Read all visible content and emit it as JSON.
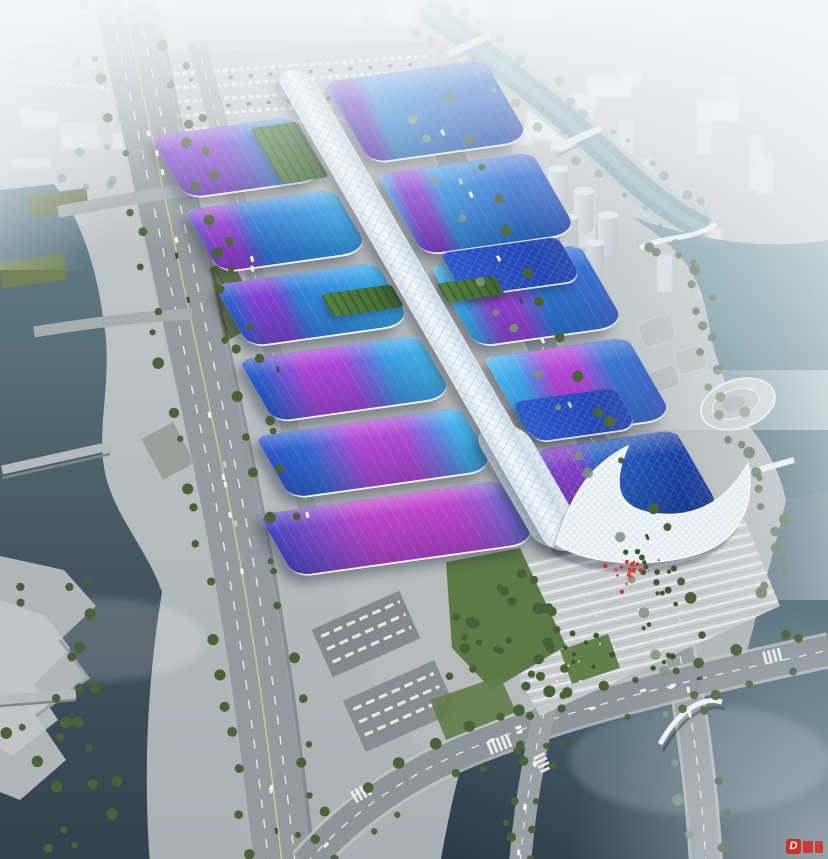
{
  "meta": {
    "type": "architectural-aerial-rendering",
    "description": "Bird's-eye rendering of a huge exhibition and convention center: two rows of wave-shaped exhibition-hall roofs in gradient blue with sweeping magenta-purple ribbon stripes flank a long white quilted central concourse spine that ends in a sculptural white wave-shaped entrance canopy and a striped palm-lined entry plaza with red festive decorations. The site is surrounded by service aprons, a tree-lined elevated riverside expressway on the left, canals and rivers with bridges, parking lots with cars and buses, lawns, terraced waterfront parks, and a hazy white city skyline fading into fog at the top."
  },
  "colors": {
    "land": "#b6babc",
    "waterRiver": "#5d7a85",
    "waterDark": "#2e3f4b",
    "waterCanal": "#7ca3ab",
    "waterRight": "#6d95a0",
    "road": "#8e959a",
    "roadMinor": "#a8adb0",
    "roadEdge": "#c3c8ca",
    "tree": "#4b6138",
    "treeHazy": "#7f947e",
    "treeBank": "#5e7452",
    "lawn": "#5c7a46",
    "palm": "#3a5a2c",
    "roofCyan": "#42b2ec",
    "roofBlue": "#2356c8",
    "roofDeep": "#12359a",
    "ribbonMagenta": "#b24ad6",
    "ribbonPurple": "#7e46d2",
    "spineWhite": "#eef4f8",
    "shellWhite": "#f4f7f9",
    "plazaBase": "#c7cbcd",
    "plazaStripe": "#e8eaeb",
    "redDecor": "#cc3526",
    "wmRed": "#d5281e",
    "cityBlock": "#e0e6ea"
  },
  "watermark": {
    "letter": "D"
  },
  "complex": {
    "halls_left": [
      {
        "w": 132,
        "g": [
          "#6a46c8",
          "#35a0e4"
        ],
        "ribbon": 26,
        "rw": 40,
        "rc": "#8a4ad2"
      },
      {
        "w": 140,
        "g": [
          "#2d62cc",
          "#38a8e8"
        ],
        "ribbon": 16,
        "rw": 22,
        "rc": "#9244ce"
      },
      {
        "w": 152,
        "g": [
          "#2b60cc",
          "#3cb0ea"
        ],
        "ribbon": 24,
        "rw": 20,
        "rc": "#7e46d2"
      },
      {
        "w": 168,
        "g": [
          "#2758c8",
          "#46b8ec"
        ],
        "ribbon": 40,
        "rw": 34,
        "rc": "#a848d8"
      },
      {
        "w": 192,
        "g": [
          "#2b55c6",
          "#48baee"
        ],
        "ribbon": 54,
        "rw": 34,
        "rc": "#b24ad6"
      },
      {
        "w": 228,
        "g": [
          "#3c43bc",
          "#3f98e2"
        ],
        "ribbon": 56,
        "rw": 58,
        "rc": "#bc46cc"
      }
    ],
    "halls_right": [
      {
        "w": 150,
        "g": [
          "#38a2e6",
          "#1e4cc0"
        ],
        "ribbon": 10,
        "rw": 14,
        "rc": "#6a3ec4"
      },
      {
        "w": 145,
        "g": [
          "#3cacea",
          "#2152c4"
        ],
        "ribbon": 16,
        "rw": 16,
        "rc": "#8844d0"
      },
      {
        "w": 140,
        "g": [
          "#42b2ec",
          "#2257c8"
        ],
        "ribbon": 34,
        "rw": 24,
        "rc": "#9a46d4"
      },
      {
        "w": 135,
        "g": [
          "#46b6ee",
          "#204ec4"
        ],
        "ribbon": 46,
        "rw": 28,
        "rc": "#b048d6"
      },
      {
        "w": 130,
        "g": [
          "#2e7ad8",
          "#12359a"
        ],
        "ribbon": 14,
        "rw": 22,
        "rc": "#7e3cc2",
        "tex": true
      }
    ],
    "annex_roofs": 2,
    "green_roofs": 3
  },
  "scene": {
    "city": {
      "far_blocks": 30,
      "right_towers": 12,
      "left_slabs": 8,
      "domes": 3
    },
    "plaza_stripes": 14,
    "red_decor_count": 22,
    "people_dots": 14
  }
}
